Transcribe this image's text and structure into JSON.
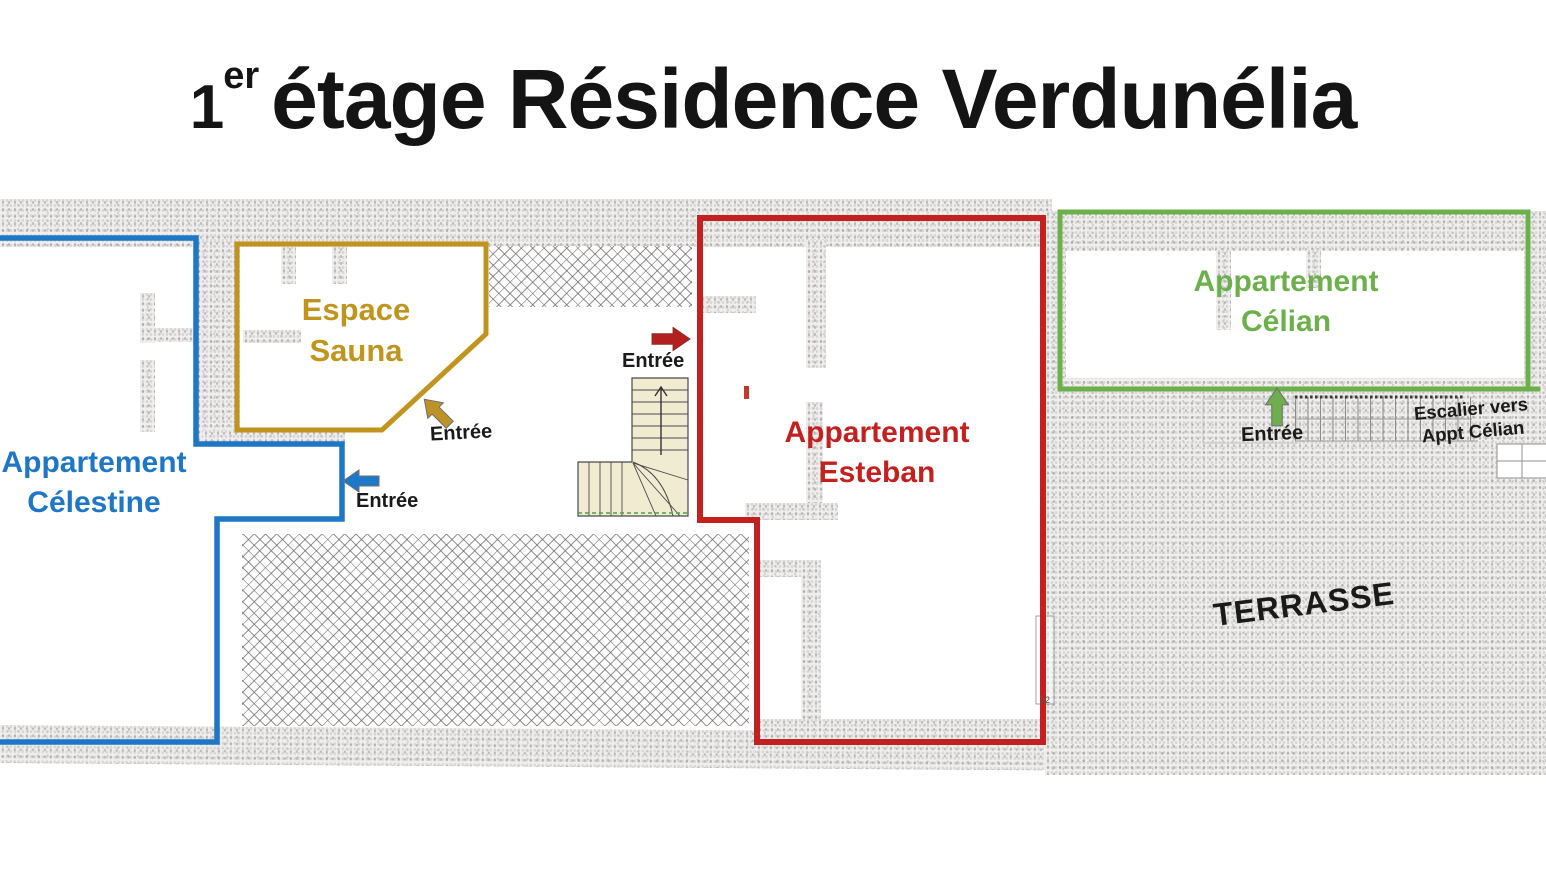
{
  "title": {
    "floor_number": "1",
    "floor_ordinal": "er",
    "rest": "étage Résidence Verdunélia"
  },
  "areas": {
    "celestine": {
      "line1": "Appartement",
      "line2": "Célestine",
      "color": "#1d76c6"
    },
    "sauna": {
      "line1": "Espace",
      "line2": "Sauna",
      "color": "#c0941d"
    },
    "esteban": {
      "line1": "Appartement",
      "line2": "Esteban",
      "color": "#c32020"
    },
    "celian": {
      "line1": "Appartement",
      "line2": "Célian",
      "color": "#6bb04b"
    },
    "terrace": {
      "label": "TERRASSE"
    }
  },
  "entrances": {
    "celestine": {
      "label": "Entrée",
      "arrow_color": "#1e78c8",
      "direction": "left"
    },
    "sauna": {
      "label": "Entrée",
      "arrow_color": "#bd9226",
      "direction": "up-left"
    },
    "esteban": {
      "label": "Entrée",
      "arrow_color": "#b3201d",
      "direction": "right"
    },
    "celian": {
      "label": "Entrée",
      "arrow_color": "#6fae4e",
      "direction": "up"
    }
  },
  "annotations": {
    "stair_note_line1": "Escalier vers",
    "stair_note_line2": "Appt Célian",
    "dimension": "22"
  }
}
